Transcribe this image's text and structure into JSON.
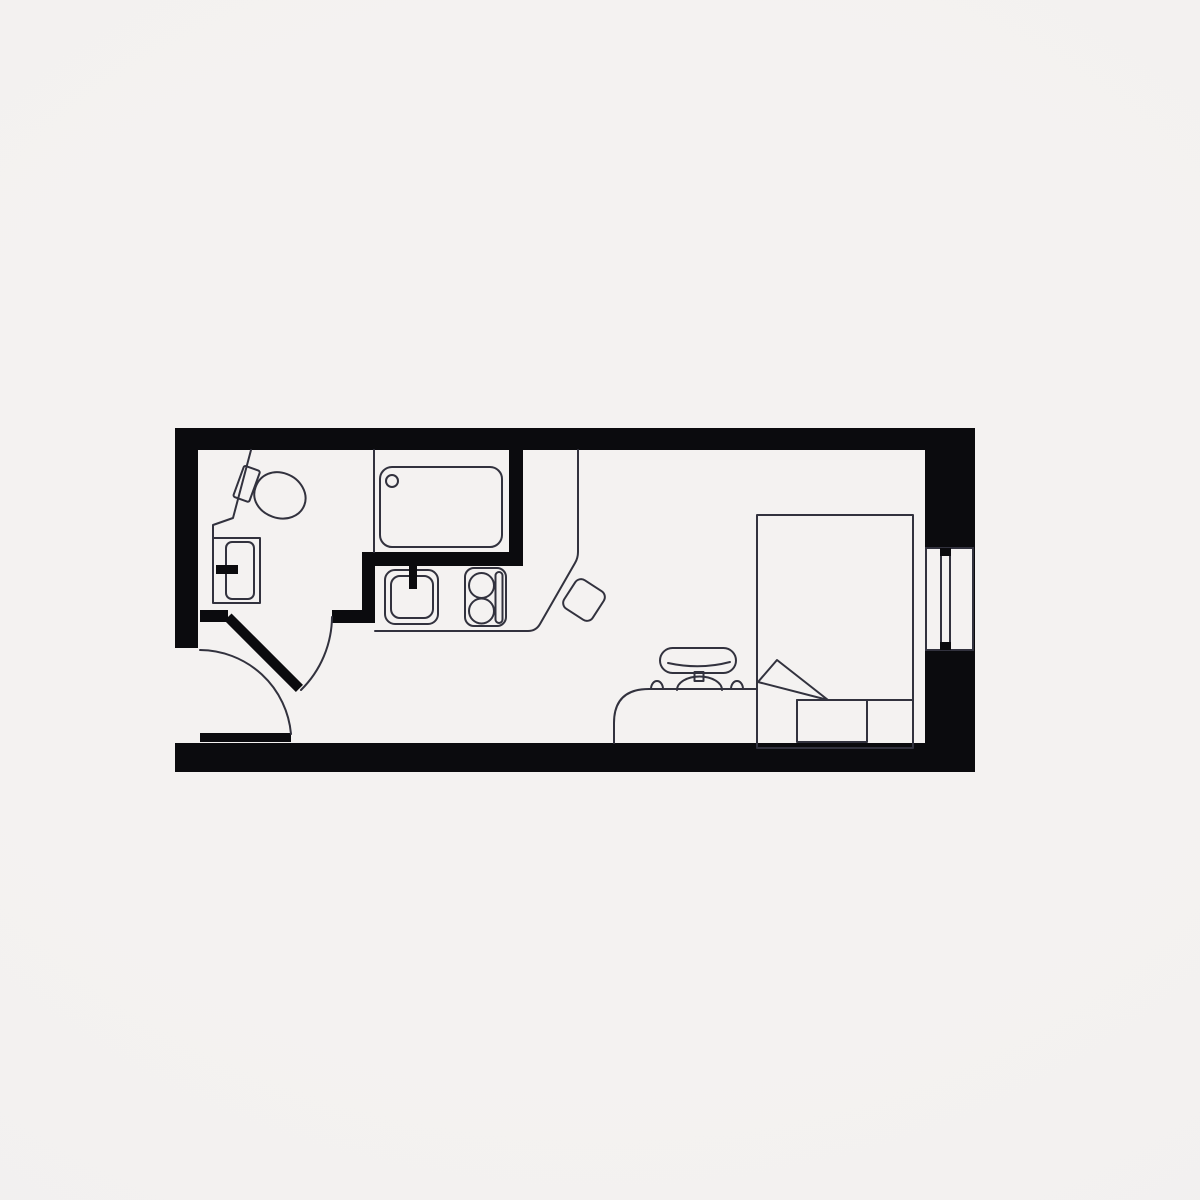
{
  "palette": {
    "background": "#f1efee",
    "background_edge": "#eae8e7",
    "floor": "#f4f2f1",
    "wall": "#0b0b0e",
    "line": "#32323e"
  },
  "plan": {
    "name": "studio-apartment-floor-plan",
    "viewBox": "0 0 1200 1200",
    "elements": [
      {
        "name": "floor-area",
        "type": "rect",
        "cls": "fill-floor",
        "attrs": {
          "x": 177,
          "y": 428,
          "width": 798,
          "height": 344
        }
      },
      {
        "name": "wall-top",
        "type": "rect",
        "cls": "wall",
        "attrs": {
          "x": 175,
          "y": 428,
          "width": 800,
          "height": 22
        }
      },
      {
        "name": "wall-left",
        "type": "rect",
        "cls": "wall",
        "attrs": {
          "x": 175,
          "y": 428,
          "width": 23,
          "height": 220
        }
      },
      {
        "name": "wall-bottom",
        "type": "rect",
        "cls": "wall",
        "attrs": {
          "x": 175,
          "y": 743,
          "width": 800,
          "height": 29
        }
      },
      {
        "name": "wall-right",
        "type": "rect",
        "cls": "wall",
        "attrs": {
          "x": 925,
          "y": 428,
          "width": 50,
          "height": 344
        }
      },
      {
        "name": "window-opening",
        "type": "rect",
        "cls": "pane",
        "attrs": {
          "x": 926,
          "y": 548,
          "width": 47,
          "height": 102
        }
      },
      {
        "name": "window-glass-strip",
        "type": "rect",
        "cls": "ln",
        "attrs": {
          "x": 941,
          "y": 551,
          "width": 9,
          "height": 95
        }
      },
      {
        "name": "window-cap-top",
        "type": "rect",
        "cls": "wall",
        "attrs": {
          "x": 940,
          "y": 548,
          "width": 11,
          "height": 8
        }
      },
      {
        "name": "window-cap-bottom",
        "type": "rect",
        "cls": "wall",
        "attrs": {
          "x": 940,
          "y": 642,
          "width": 11,
          "height": 8
        }
      },
      {
        "name": "bathroom-wall-horizontal",
        "type": "rect",
        "cls": "wall",
        "attrs": {
          "x": 362,
          "y": 552,
          "width": 161,
          "height": 14
        }
      },
      {
        "name": "bathroom-wall-vertical-right",
        "type": "rect",
        "cls": "wall",
        "attrs": {
          "x": 509,
          "y": 448,
          "width": 14,
          "height": 110
        }
      },
      {
        "name": "bathroom-wall-vertical-left",
        "type": "rect",
        "cls": "wall",
        "attrs": {
          "x": 362,
          "y": 552,
          "width": 13,
          "height": 71
        }
      },
      {
        "name": "bathroom-door-stub-right",
        "type": "rect",
        "cls": "wall",
        "attrs": {
          "x": 332,
          "y": 610,
          "width": 43,
          "height": 13
        }
      },
      {
        "name": "bathroom-door-stub-left",
        "type": "rect",
        "cls": "wall",
        "attrs": {
          "x": 200,
          "y": 610,
          "width": 28,
          "height": 12
        }
      },
      {
        "name": "bathroom-door-leaf",
        "type": "rect",
        "cls": "wall",
        "attrs": {
          "x": 228,
          "y": 612,
          "width": 101,
          "height": 10,
          "transform": "rotate(45 228 617)"
        }
      },
      {
        "name": "bathroom-door-swing-arc",
        "type": "path",
        "cls": "ln",
        "attrs": {
          "d": "M 332,617 A 104,104 0 0 1 301,690"
        }
      },
      {
        "name": "entry-door-leaf",
        "type": "rect",
        "cls": "wall",
        "attrs": {
          "x": 200,
          "y": 733,
          "width": 91,
          "height": 9
        }
      },
      {
        "name": "entry-door-swing-arc",
        "type": "path",
        "cls": "ln",
        "attrs": {
          "d": "M 200,650 A 92,92 0 0 1 291,734"
        }
      },
      {
        "name": "shower-screen",
        "type": "path",
        "cls": "ln",
        "attrs": {
          "d": "M 374,450 L 374,552"
        }
      },
      {
        "name": "shower-tray",
        "type": "rect",
        "cls": "ln",
        "attrs": {
          "x": 380,
          "y": 467,
          "width": 122,
          "height": 80,
          "rx": 12
        }
      },
      {
        "name": "shower-drain",
        "type": "circle",
        "cls": "ln",
        "attrs": {
          "cx": 392,
          "cy": 481,
          "r": 6
        }
      },
      {
        "name": "kitchen-counter-edge",
        "type": "path",
        "cls": "ln",
        "attrs": {
          "d": "M 375,631 L 528,631 Q 536,631 540,624 L 575,563 Q 578,558 578,552 L 578,450"
        }
      },
      {
        "name": "kitchen-sink-outer",
        "type": "rect",
        "cls": "ln",
        "attrs": {
          "x": 385,
          "y": 570,
          "width": 53,
          "height": 54,
          "rx": 10
        }
      },
      {
        "name": "kitchen-sink-inner",
        "type": "rect",
        "cls": "ln",
        "attrs": {
          "x": 391,
          "y": 576,
          "width": 42,
          "height": 42,
          "rx": 9
        }
      },
      {
        "name": "kitchen-faucet",
        "type": "rect",
        "cls": "wall",
        "attrs": {
          "x": 409,
          "y": 564,
          "width": 8,
          "height": 25
        }
      },
      {
        "name": "hob",
        "type": "rect",
        "cls": "ln",
        "attrs": {
          "x": 465,
          "y": 568,
          "width": 41,
          "height": 58,
          "rx": 9
        }
      },
      {
        "name": "hob-burner-top",
        "type": "circle",
        "cls": "ln",
        "attrs": {
          "cx": 481.5,
          "cy": 585.5,
          "r": 12.5
        }
      },
      {
        "name": "hob-burner-bottom",
        "type": "circle",
        "cls": "ln",
        "attrs": {
          "cx": 481.5,
          "cy": 611,
          "r": 12.5
        }
      },
      {
        "name": "hob-control-strip",
        "type": "rect",
        "cls": "ln",
        "attrs": {
          "x": 495.5,
          "y": 572,
          "width": 7,
          "height": 51,
          "rx": 3.5
        }
      },
      {
        "name": "stool",
        "type": "rect",
        "cls": "ln",
        "attrs": {
          "x": 567,
          "y": 583,
          "width": 34,
          "height": 34,
          "rx": 7,
          "transform": "rotate(33 584 600)"
        }
      },
      {
        "name": "bathroom-ledge",
        "type": "path",
        "cls": "ln",
        "attrs": {
          "d": "M 251,450 L 233,518 L 213,525 L 213,538"
        }
      },
      {
        "name": "basin-outer",
        "type": "rect",
        "cls": "ln",
        "attrs": {
          "x": 213,
          "y": 538,
          "width": 47,
          "height": 65
        }
      },
      {
        "name": "basin-inner",
        "type": "rect",
        "cls": "ln",
        "attrs": {
          "x": 226,
          "y": 542,
          "width": 28,
          "height": 57,
          "rx": 6
        }
      },
      {
        "name": "basin-faucet",
        "type": "rect",
        "cls": "wall",
        "attrs": {
          "x": 216,
          "y": 565,
          "width": 22,
          "height": 9
        }
      },
      {
        "name": "toilet",
        "type": "g",
        "cls": "",
        "attrs": {
          "transform": "translate(280 496) rotate(20)"
        },
        "children": [
          {
            "name": "toilet-cistern",
            "type": "rect",
            "cls": "ln",
            "attrs": {
              "x": -44,
              "y": -16.5,
              "width": 17,
              "height": 33,
              "rx": 2
            }
          },
          {
            "name": "toilet-bowl",
            "type": "path",
            "cls": "ln",
            "attrs": {
              "d": "M -26,0 C -26,-14 -15,-23 -1,-23 C 14,-23 26,-12 26,0 C 26,12 15,22 0,22 C -15,22 -26,13 -26,0 Z"
            }
          }
        ]
      },
      {
        "name": "bed",
        "type": "rect",
        "cls": "ln",
        "attrs": {
          "x": 757,
          "y": 515,
          "width": 156,
          "height": 233
        }
      },
      {
        "name": "bed-blanket-line",
        "type": "path",
        "cls": "ln",
        "attrs": {
          "d": "M 797,700 L 913,700"
        }
      },
      {
        "name": "pillow",
        "type": "rect",
        "cls": "ln",
        "attrs": {
          "x": 797,
          "y": 700,
          "width": 70,
          "height": 42
        }
      },
      {
        "name": "duvet-fold",
        "type": "path",
        "cls": "ln",
        "attrs": {
          "d": "M 777,660 L 758,682 L 828,700 Z"
        }
      },
      {
        "name": "desk",
        "type": "path",
        "cls": "ln",
        "attrs": {
          "d": "M 757,689 L 649,689 Q 614,689 614,723 L 614,743"
        }
      },
      {
        "name": "desk-bump-left",
        "type": "path",
        "cls": "ln",
        "attrs": {
          "d": "M 651,689 A 6,8 0 0 1 663,689"
        }
      },
      {
        "name": "desk-bump-right",
        "type": "path",
        "cls": "ln",
        "attrs": {
          "d": "M 731,689 A 6,8 0 0 1 743,689"
        }
      },
      {
        "name": "chair-backrest",
        "type": "rect",
        "cls": "ln",
        "attrs": {
          "x": 660,
          "y": 648,
          "width": 76,
          "height": 25,
          "rx": 12.5
        }
      },
      {
        "name": "chair-backrest-line",
        "type": "path",
        "cls": "ln",
        "attrs": {
          "d": "M 668,663 Q 700,670 730,662"
        }
      },
      {
        "name": "chair-stem",
        "type": "rect",
        "cls": "ln",
        "attrs": {
          "x": 694.5,
          "y": 672,
          "width": 9,
          "height": 9
        }
      },
      {
        "name": "chair-seat",
        "type": "path",
        "cls": "ln",
        "attrs": {
          "d": "M 677,690 A 22.5,13.5 0 0 1 722,690"
        }
      }
    ]
  }
}
